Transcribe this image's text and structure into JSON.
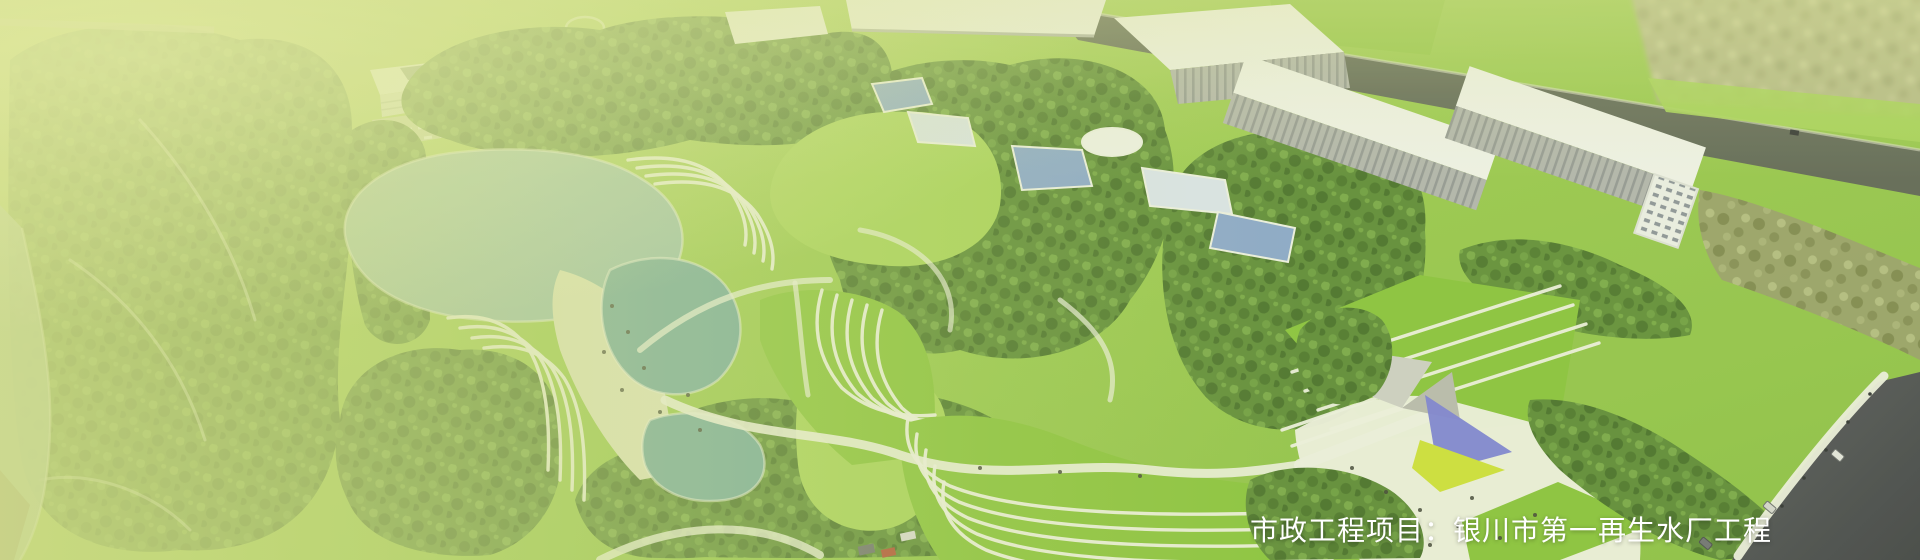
{
  "caption": {
    "text": "市政工程项目：银川市第一再生水厂工程"
  },
  "scene": {
    "type": "aerial-architectural-rendering",
    "subject": "reclaimed water plant park, lake, terraced lawns, white plant buildings, entrance plaza",
    "colors": {
      "wash": "#d4de8e",
      "tint": "#c2d372",
      "lawn": "#97c74b",
      "lawn_bright": "#8ac33e",
      "lawn_light": "#a9d35c",
      "forest": "#5e8b39",
      "forest_dark": "#48702c",
      "forest_light": "#7cab4b",
      "olive": "#9a9e6e",
      "olive_dark": "#7d8152",
      "olive_light": "#b8bc8a",
      "lake": "#9bc0af",
      "lake_deep": "#73a9a1",
      "sand": "#dfe4bf",
      "path": "#eff1e4",
      "building": "#f2f3ee",
      "building_shade": "#b3b5b1",
      "road": "#4c4e55",
      "road_dark": "#3f4147",
      "pool": "#8aa7d0",
      "pool_light": "#dce5f0",
      "canopy_blue": "#7b80d8",
      "canopy_yellow": "#cfe03c",
      "canal": "#aec7b4",
      "caption": "#ffffff"
    }
  }
}
